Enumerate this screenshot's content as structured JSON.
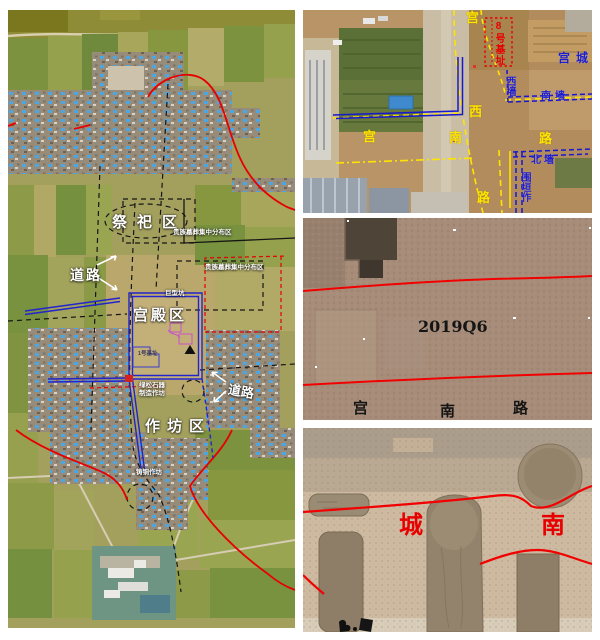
{
  "site_map": {
    "sacrificial_area_label": "祭祀区",
    "noble_tombs_label_top": "贵族墓葬集中分布区",
    "noble_tombs_label_right": "贵族墓葬集中分布区",
    "road_label_west": "道路",
    "road_label_east": "道路",
    "palace_area_label": "宫殿区",
    "giant_pit_label": "巨型坑",
    "foundation_no1_label": "1号基址",
    "turquoise_workshop_line1": "绿松石器",
    "turquoise_workshop_line2": "制造作坊",
    "workshop_area_label": "作坊区",
    "bronze_workshop_label": "铸铜作坊"
  },
  "palace_roads_photo": {
    "vertical_road_chars": [
      "宫",
      "西",
      "路"
    ],
    "horizontal_road_chars": [
      "宫",
      "南",
      "路"
    ],
    "palace_city_label": "宫城",
    "foundation_no8_label": "8号基址",
    "west_wall_label": "西墙",
    "south_wall_label": "南墙",
    "north_wall_label": "北墙",
    "enclosure_label_partial": "围垣作"
  },
  "trench_q6_photo": {
    "trench_id": "2019Q6",
    "road_chars": [
      "宫",
      "南",
      "路"
    ]
  },
  "city_south_photo": {
    "char_left": "城",
    "char_right": "南"
  },
  "colors": {
    "annotation_red": "#e60000",
    "annotation_blue": "#2222cc",
    "annotation_yellow": "#ffe400",
    "label_white": "#ffffff",
    "label_black": "#151515"
  }
}
